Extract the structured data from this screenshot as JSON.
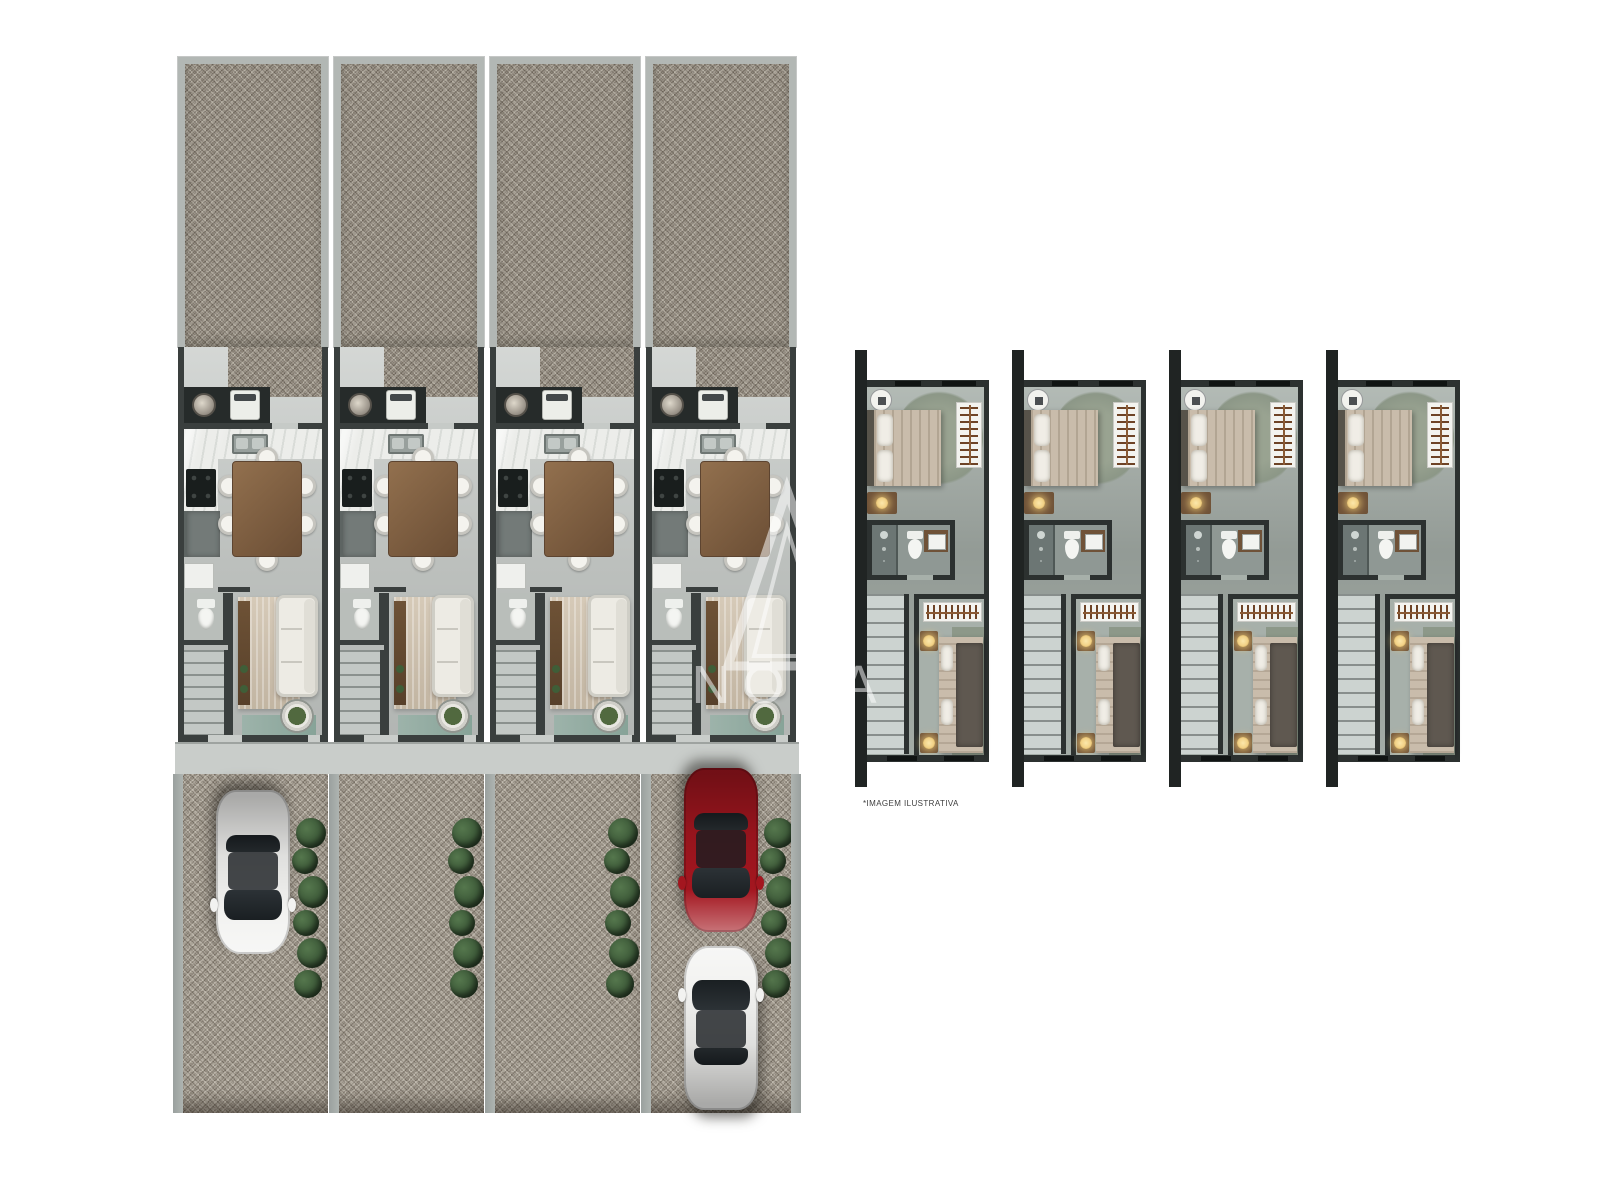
{
  "type": "architectural-floorplan-render",
  "caption": "*IMAGEM ILUSTRATIVA",
  "watermark": {
    "text": "NOVA"
  },
  "palette": {
    "wall_dark": "#3a3f3e",
    "wall_light": "#b2b7b4",
    "floor": "#c6cac7",
    "marble": "#ecedea",
    "gravel_yard": "#948c7f",
    "gravel_drive": "#a69e90",
    "porch": "#c9cdca",
    "hedge": "#3e5a39",
    "car_red": "#a3161f",
    "car_white": "#f2f2f0",
    "upper_floor_color": "#a7b0aa",
    "upper_rug": "#8d9889",
    "post": "#202423",
    "stair": "#ccd3d0",
    "nightstand_wood": "#6f5238",
    "lamp_glow": "#f2d287",
    "blanket_dark": "#5f5850"
  },
  "ground_floor": {
    "unit_pitch": 156,
    "units": [
      {
        "id": "ground-unit-1",
        "cars": [
          {
            "color_name": "white",
            "facing": "down",
            "top": 16
          }
        ]
      },
      {
        "id": "ground-unit-2",
        "cars": []
      },
      {
        "id": "ground-unit-3",
        "cars": []
      },
      {
        "id": "ground-unit-4",
        "cars": [
          {
            "color_name": "red",
            "facing": "down",
            "top": -6
          },
          {
            "color_name": "white",
            "facing": "up",
            "top": 172
          }
        ]
      }
    ]
  },
  "upper_floor": {
    "unit_pitch": 157,
    "units": [
      {
        "id": "upper-unit-1"
      },
      {
        "id": "upper-unit-2"
      },
      {
        "id": "upper-unit-3"
      },
      {
        "id": "upper-unit-4"
      }
    ]
  }
}
